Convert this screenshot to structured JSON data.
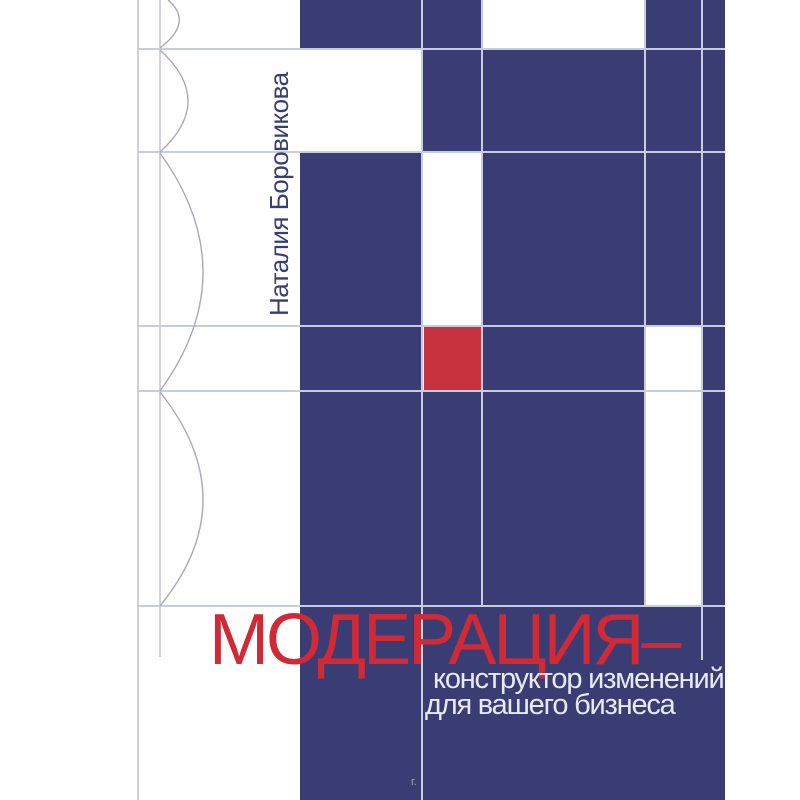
{
  "cover": {
    "author": "Наталия Боровикова",
    "title": "МОДЕРАЦИЯ–",
    "subtitle": {
      "line1": "конструктор изменений",
      "line2": "для вашего бизнеса"
    },
    "watermark": "г.",
    "colors": {
      "background": "#ffffff",
      "navy": "#3a3d73",
      "red_square": "#c8323f",
      "title_red": "#cf2a36",
      "subtitle_text": "#e7eaf3",
      "gridline": "#c8cdde",
      "margin_line": "#d2d3d8",
      "arc_line": "#a9abb4",
      "author_text": "#3a3d73"
    }
  }
}
